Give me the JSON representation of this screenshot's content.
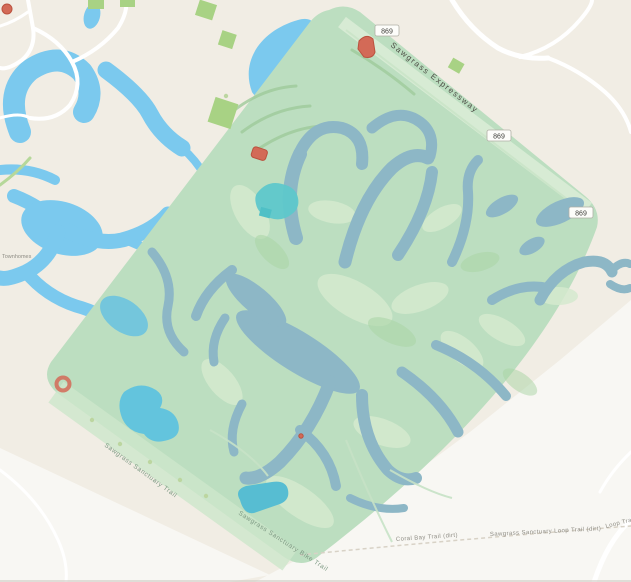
{
  "app": {
    "title": "Map view — nature reserve with lakes"
  },
  "map": {
    "style": "openstreetmap",
    "labels": {
      "expressway": "Sawgrass Expressway",
      "route_shield": "869",
      "sw_trail_upper": "Sawgrass Sanctuary Trail",
      "sw_trail_lower": "Sawgrass Sanctuary Bike Trail",
      "bottom_trail_left": "Coral Bay Trail (dirt)",
      "bottom_trail_right": "Sawgrass Sanctuary Loop Trail (dirt)",
      "bottom_trail_far_right": "Loop Trail (dirt)",
      "neighborhood_left": "Townhomes"
    },
    "palette": {
      "land": "#f1ede4",
      "land_light": "#f8f7f3",
      "water": "#7bc9ee",
      "water_teal": "#57bdd2",
      "water_teal_bright": "#5ec7cb",
      "pond_muted": "#8db7c6",
      "reserve": "#bcdec0",
      "reserve_light": "#d5eacf",
      "fairway": "#a9d3a3",
      "treerow": "#9fcb9b",
      "park_green": "#a8d284",
      "building_red": "#d36a57",
      "building_red_dark": "#bb523f",
      "road": "#ffffff",
      "road_green": "#b6d89a",
      "label_dark": "#4e4e46",
      "label_faint": "#7e9a84",
      "label_gray": "#8f8d85"
    }
  }
}
